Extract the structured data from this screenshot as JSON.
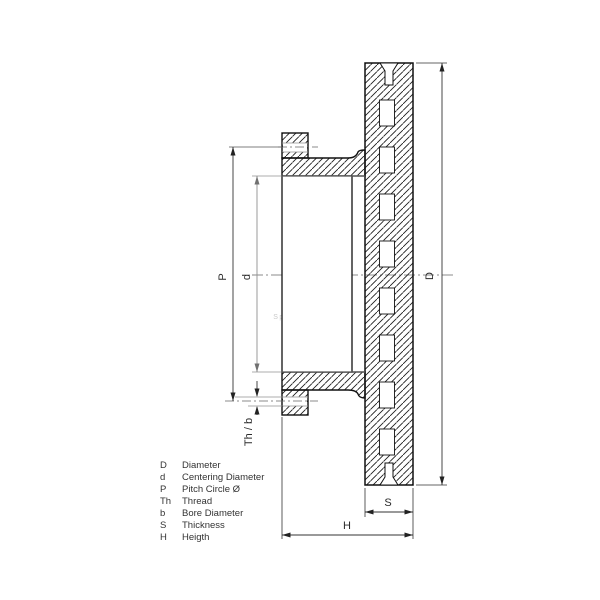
{
  "drawing": {
    "title": "Brake disc cross section",
    "dimension_labels": {
      "pitch_circle": "P",
      "centering_diameter": "d",
      "outer_diameter": "D",
      "thread_bore": "Th / b",
      "thickness": "S",
      "height": "H"
    },
    "watermark": {
      "logo": "dt",
      "registered": "®",
      "subtext": "Spare Parts"
    },
    "colors": {
      "line": "#1a1a1a",
      "dim_line": "#333333",
      "gray_dim": "#909090",
      "centerline": "#666666",
      "watermark": "#c9c9c9",
      "background": "#ffffff"
    }
  },
  "legend": {
    "rows": [
      {
        "symbol": "D",
        "label": "Diameter"
      },
      {
        "symbol": "d",
        "label": "Centering Diameter"
      },
      {
        "symbol": "P",
        "label": "Pitch Circle Ø"
      },
      {
        "symbol": "Th",
        "label": "Thread"
      },
      {
        "symbol": "b",
        "label": "Bore Diameter"
      },
      {
        "symbol": "S",
        "label": "Thickness"
      },
      {
        "symbol": "H",
        "label": "Heigth"
      }
    ]
  }
}
